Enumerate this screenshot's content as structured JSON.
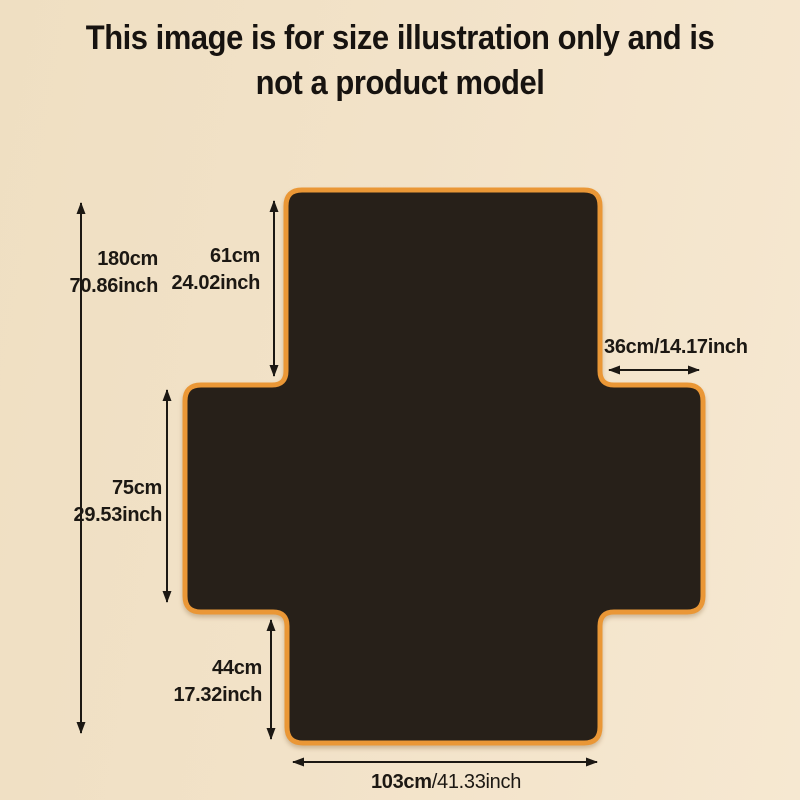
{
  "title": {
    "line1": "This image is for size illustration only and is",
    "line2": "not a product model"
  },
  "dimensions": {
    "total_height": {
      "cm": "180cm",
      "inch": "70.86inch"
    },
    "top_section_height": {
      "cm": "61cm",
      "inch": "24.02inch"
    },
    "side_width": {
      "text": "36cm/14.17inch"
    },
    "middle_section_height": {
      "cm": "75cm",
      "inch": "29.53inch"
    },
    "bottom_section_height": {
      "cm": "44cm",
      "inch": "17.32inch"
    },
    "bottom_width": {
      "cm": "103cm",
      "inch": "/41.33inch"
    }
  },
  "colors": {
    "background": "#f2e2c8",
    "shape_fill": "#272019",
    "shape_border": "#ea9736",
    "text": "#1c1813"
  }
}
